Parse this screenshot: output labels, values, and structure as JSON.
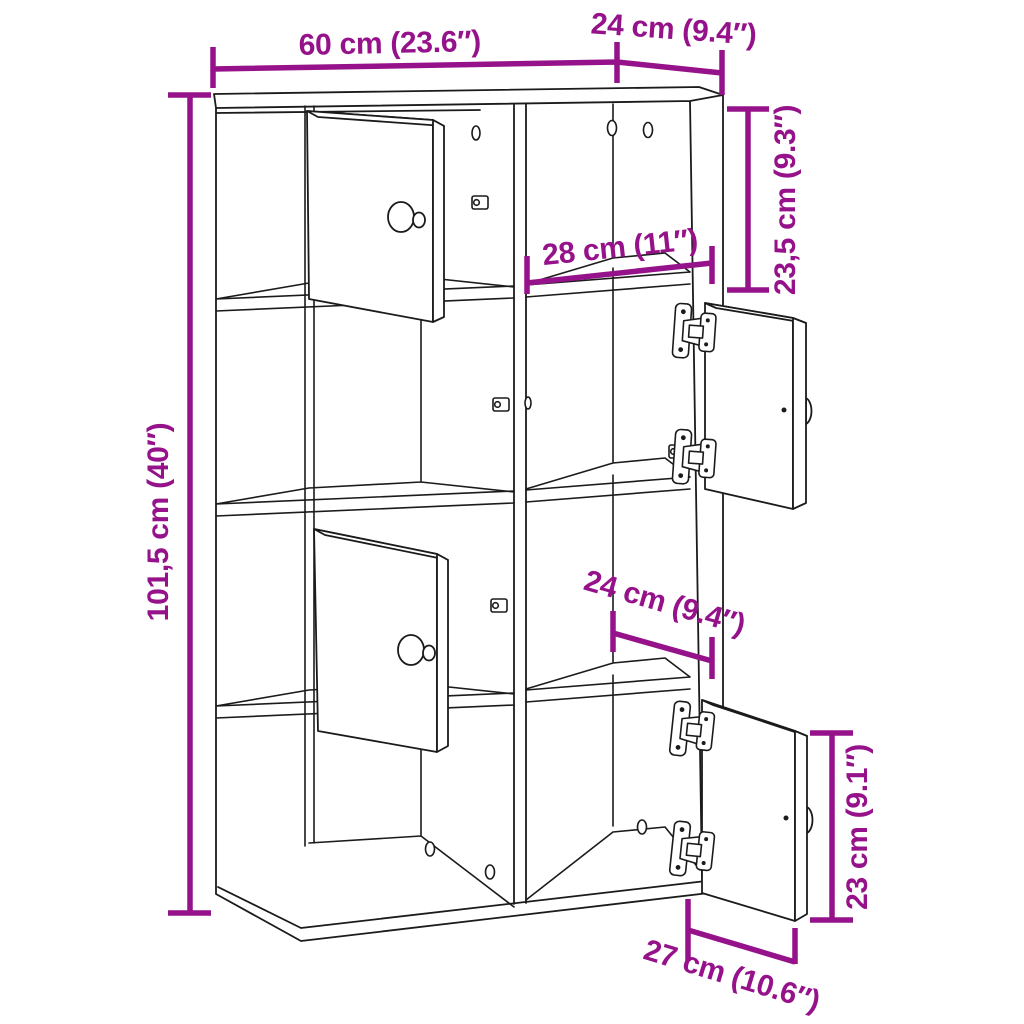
{
  "diagram": {
    "kind": "furniture-dimension-diagram",
    "subject": "bookcase with open doors",
    "accent_color": "#96128a",
    "line_color": "#1b1b1b",
    "background_color": "#ffffff",
    "labels": {
      "width": "60 cm (23.6″)",
      "depth": "24 cm (9.4″)",
      "height": "101,5 cm (40″)",
      "top_section_height": "23,5 cm (9.3″)",
      "inner_width": "28 cm (11″)",
      "inner_depth": "24 cm (9.4″)",
      "door_height": "23 cm (9.1″)",
      "door_width": "27 cm (10.6″)"
    }
  }
}
